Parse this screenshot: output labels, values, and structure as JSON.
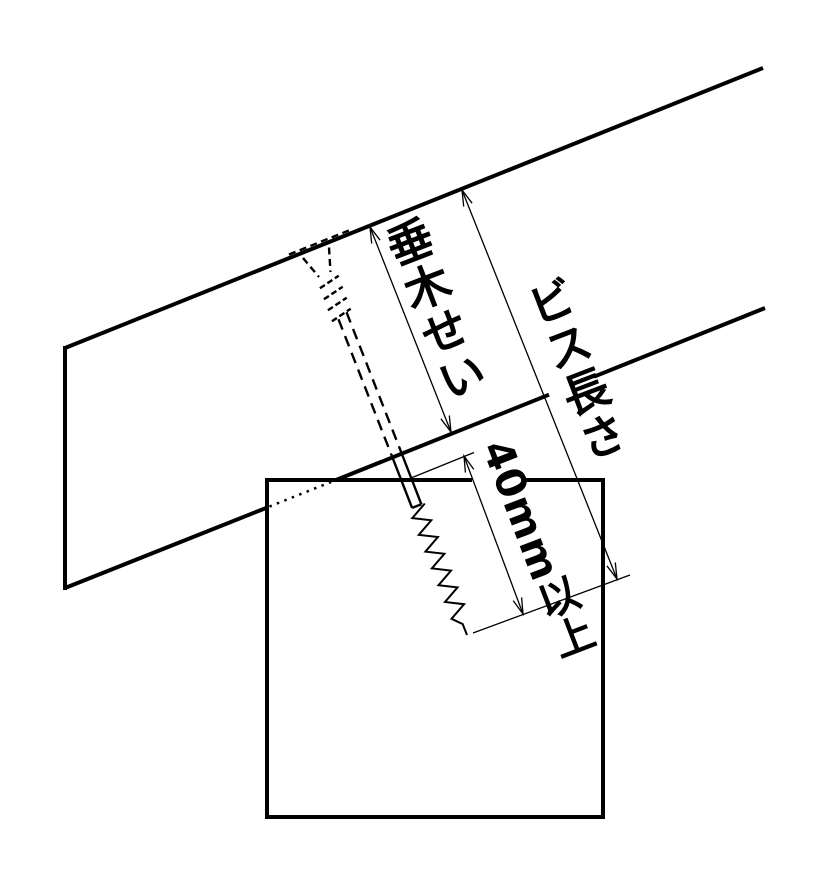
{
  "diagram": {
    "background_color": "#ffffff",
    "line_color": "#000000",
    "labels": {
      "rafter_depth": "垂木せい",
      "screw_length": "ビス長さ",
      "min_penetration": "40mm以上"
    }
  }
}
